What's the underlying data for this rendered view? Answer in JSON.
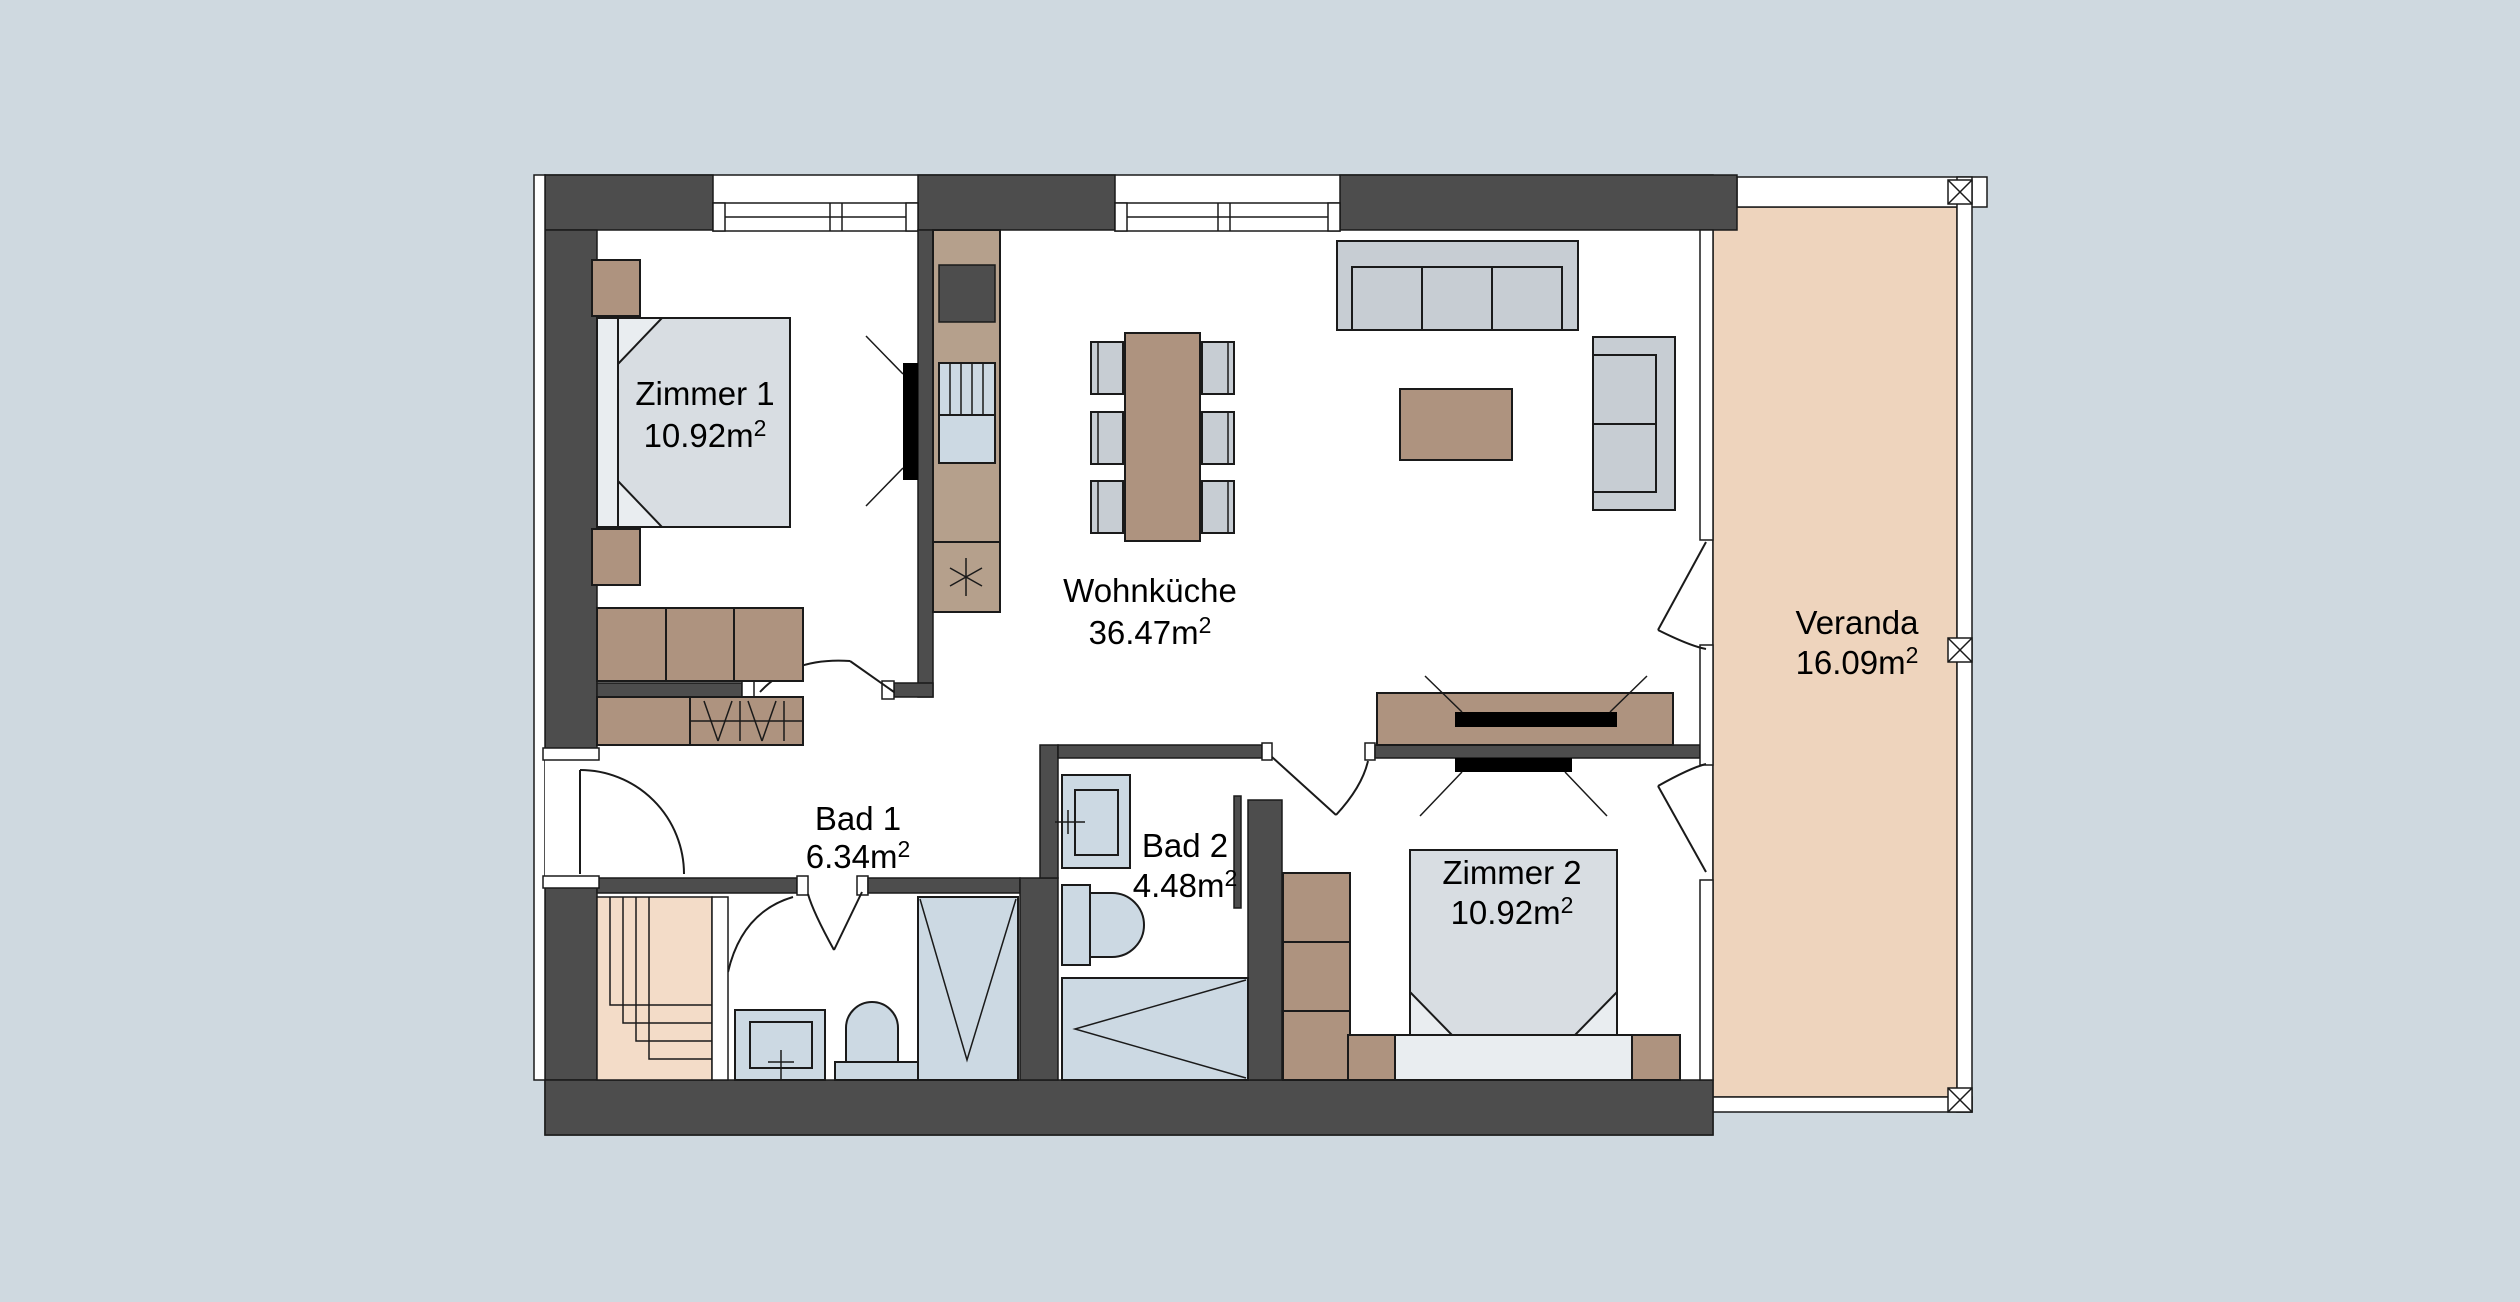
{
  "colors": {
    "background": "#cfd9e0",
    "wall": "#4d4d4d",
    "wood": "#ae937f",
    "kitchen_counter": "#b5a08c",
    "fabric": "#c7cdd3",
    "fixture": "#ccd9e3",
    "bed": "#d8dde2",
    "bed_light": "#e9edf0",
    "veranda_floor": "#eed4bd",
    "stairs": "#f3dcc8",
    "tv": "#000000",
    "outline": "#1a1a1a"
  },
  "rooms": {
    "zimmer1": {
      "name": "Zimmer 1",
      "area": "10.92m",
      "sup": "2"
    },
    "wohnkueche": {
      "name": "Wohnküche",
      "area": "36.47m",
      "sup": "2"
    },
    "bad1": {
      "name": "Bad 1",
      "area": "6.34m",
      "sup": "2"
    },
    "bad2": {
      "name": "Bad 2",
      "area": "4.48m",
      "sup": "2"
    },
    "zimmer2": {
      "name": "Zimmer 2",
      "area": "10.92m",
      "sup": "2"
    },
    "veranda": {
      "name": "Veranda",
      "area": "16.09m",
      "sup": "2"
    }
  },
  "icons": {
    "railing-post": "boxed-x",
    "stove": "asterisk",
    "door": "quarter-arc-swing",
    "window": "double-line-band"
  }
}
